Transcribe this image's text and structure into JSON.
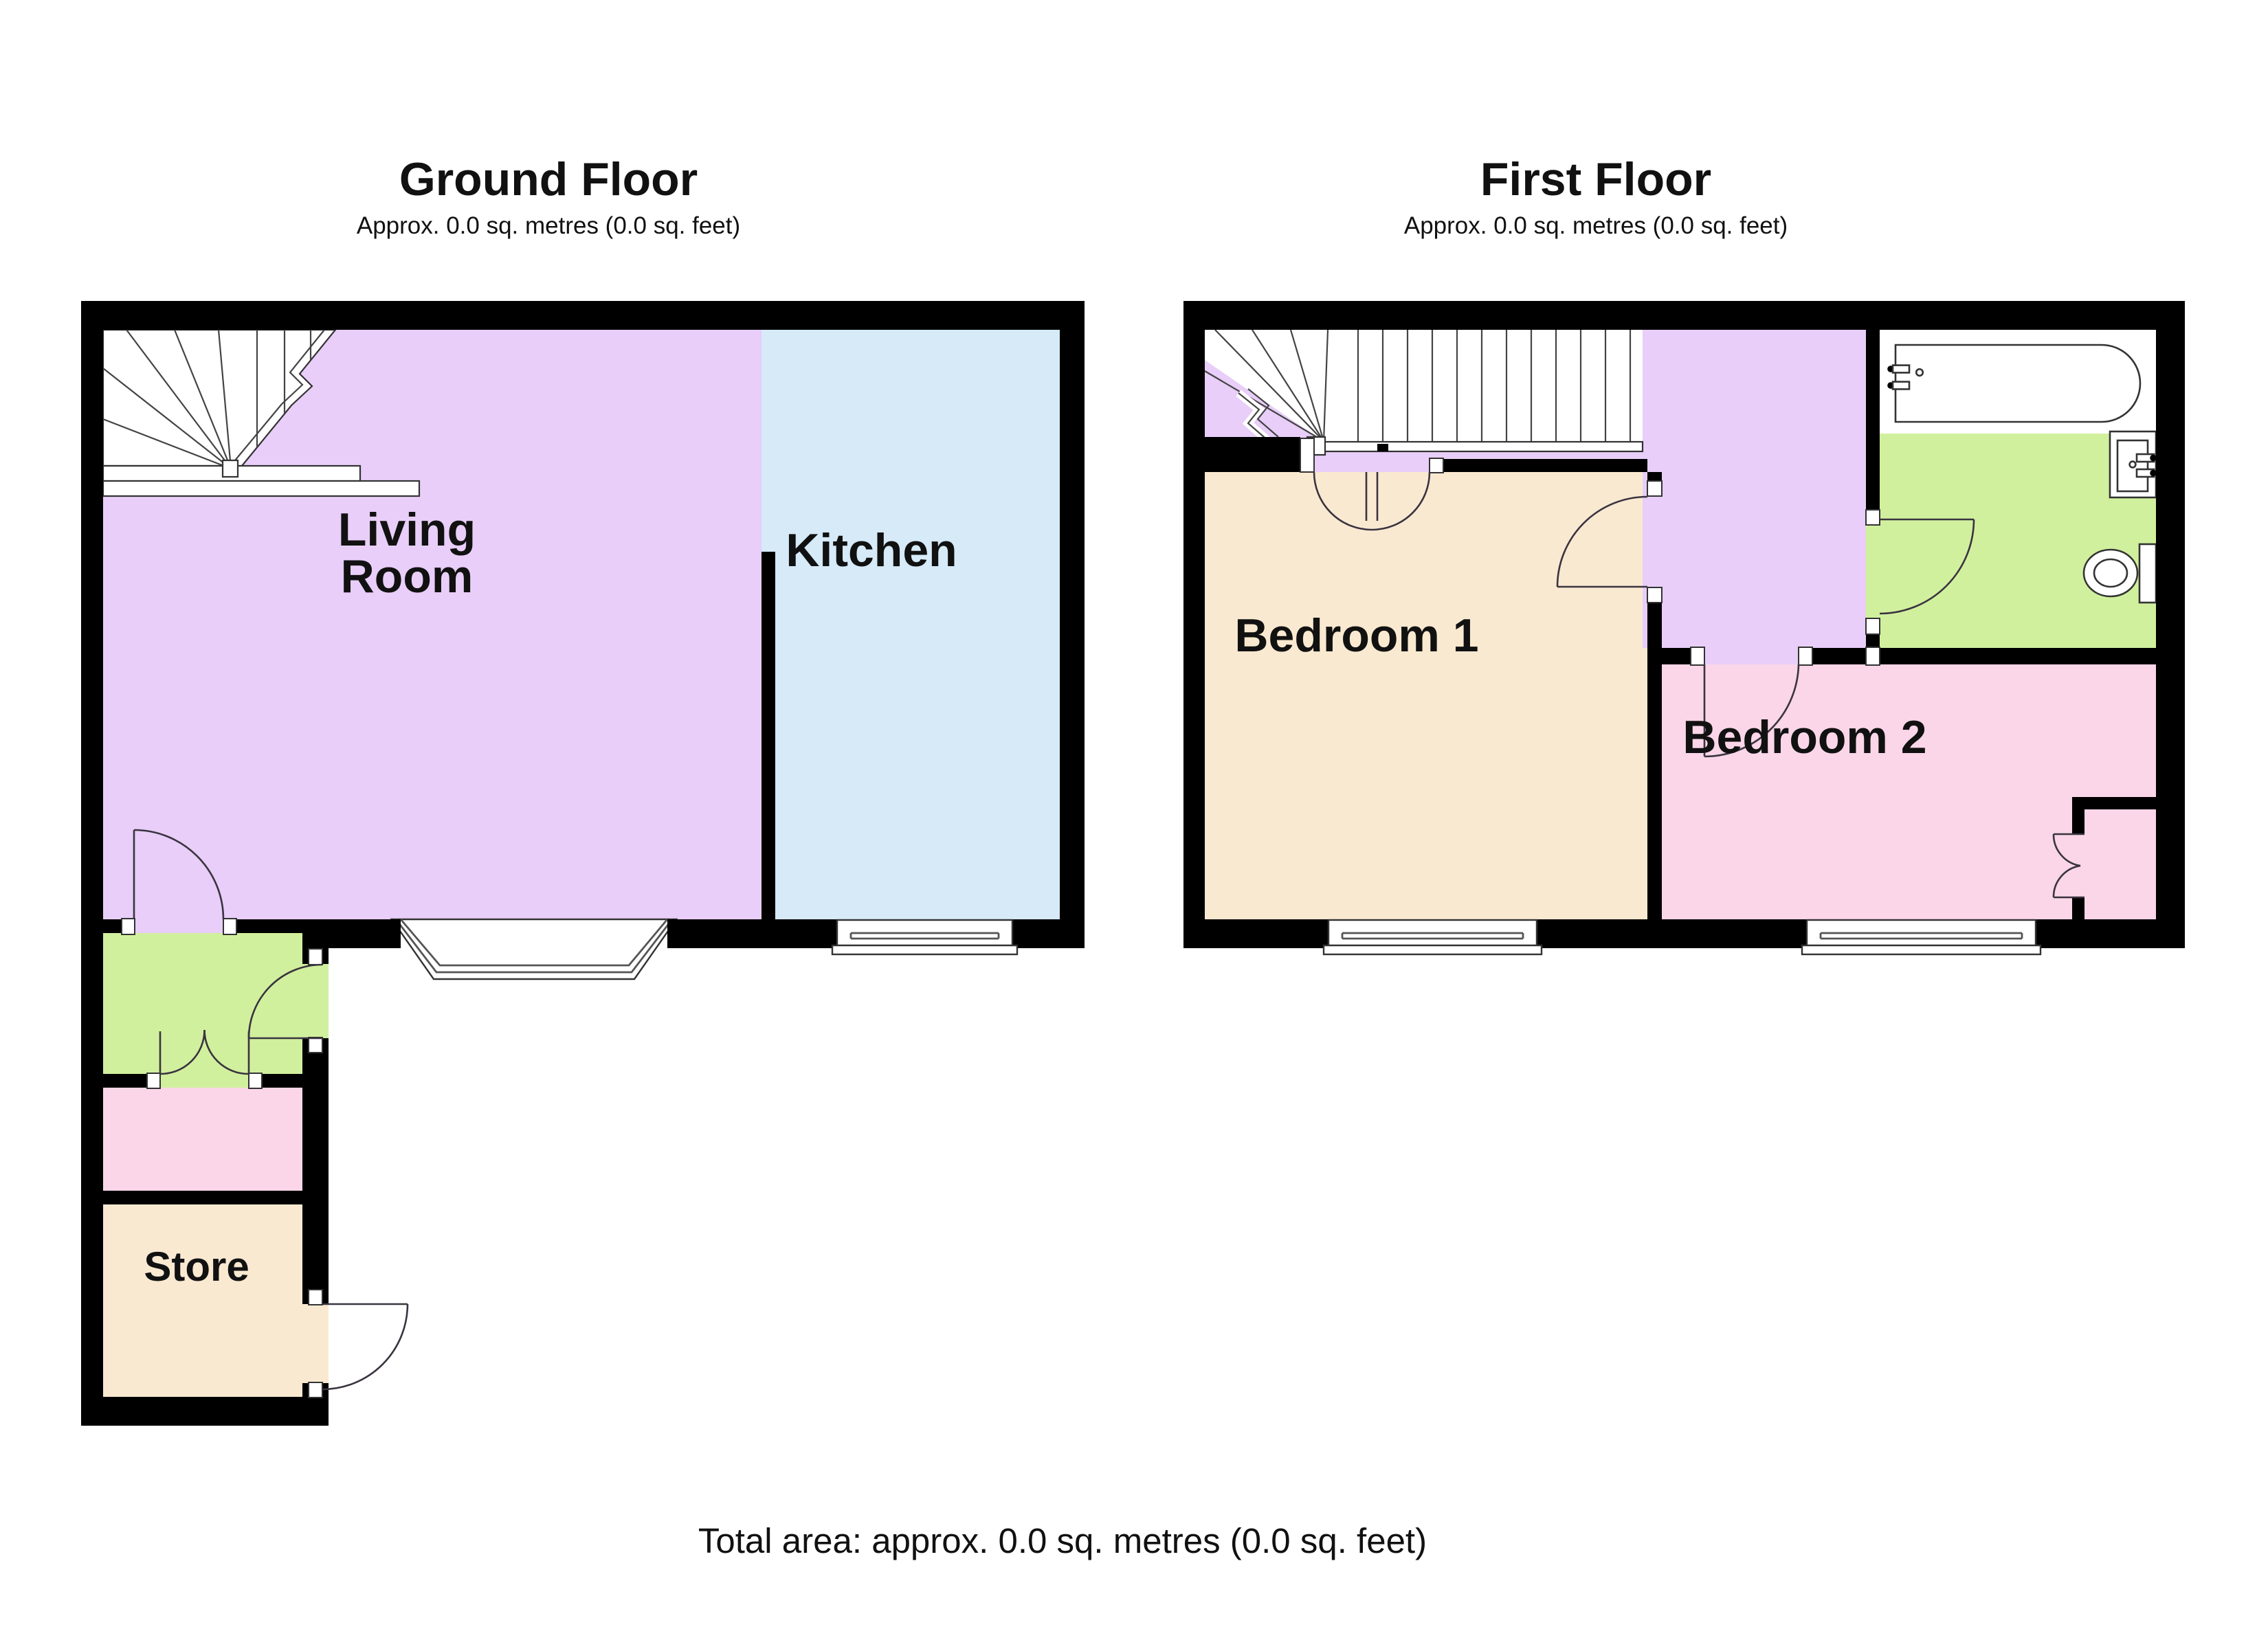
{
  "ground_floor": {
    "title": "Ground Floor",
    "subtitle": "Approx. 0.0 sq. metres (0.0 sq. feet)",
    "rooms": {
      "living_room_line1": "Living",
      "living_room_line2": "Room",
      "kitchen": "Kitchen",
      "store": "Store"
    }
  },
  "first_floor": {
    "title": "First Floor",
    "subtitle": "Approx. 0.0 sq. metres (0.0 sq. feet)",
    "rooms": {
      "bedroom1": "Bedroom 1",
      "bedroom2": "Bedroom 2"
    }
  },
  "footer": {
    "total_area": "Total area: approx. 0.0 sq. metres (0.0 sq. feet)"
  },
  "colors": {
    "wall": "#000000",
    "purple": "#E8CEF8",
    "blue": "#D6EAF8",
    "green": "#D1F09E",
    "pink": "#FAD6E8",
    "cream": "#FAE9D1"
  }
}
